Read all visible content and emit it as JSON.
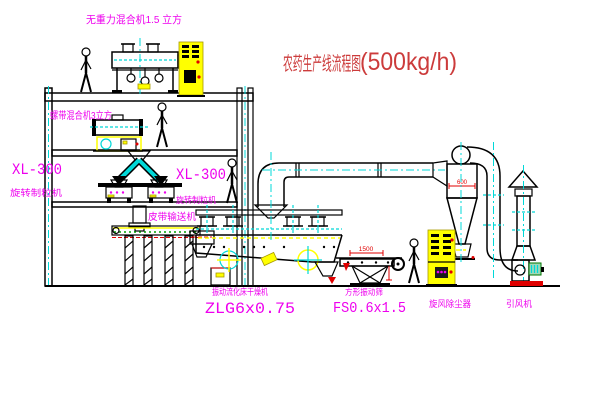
{
  "title": {
    "name": "农药生产线流程图",
    "capacity": "(500kg/h)"
  },
  "labels": {
    "top_mixer": "无重力混合机1.5 立方",
    "second_mixer": "螺带混合机3立方",
    "granulator_left_model": "XL-300",
    "granulator_left_name": "旋转制粒机",
    "granulator_right_model": "XL-300",
    "granulator_right_name": "旋转制粒机",
    "belt_conveyor": "皮带输送机",
    "dryer_name": "振动流化床干燥机",
    "dryer_model": "ZLG6x0.75",
    "screen_name": "方形振动筛",
    "screen_model": "FS0.6x1.5",
    "cyclone": "旋风除尘器",
    "fan": "引风机"
  },
  "dimensions": {
    "screen_length": "1500",
    "cyclone_diameter": "600"
  },
  "colors": {
    "background": "#ffffff",
    "line": "#000000",
    "label_magenta": "#ee00ee",
    "title_red": "#cc3b3b",
    "centerline_cyan": "#00d8d8",
    "cabinet_yellow": "#ffff00",
    "accent_red": "#e00000",
    "accent_green": "#00a000"
  }
}
